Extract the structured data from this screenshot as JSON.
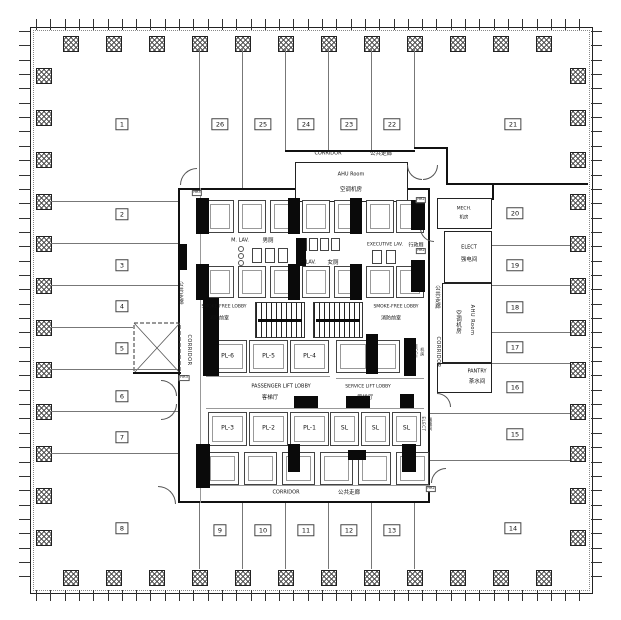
{
  "drawing": {
    "title": "office tower typical floor plan",
    "rooms": [
      "1",
      "2",
      "3",
      "4",
      "5",
      "6",
      "7",
      "8",
      "9",
      "10",
      "11",
      "12",
      "13",
      "14",
      "15",
      "16",
      "17",
      "18",
      "19",
      "20",
      "21",
      "22",
      "23",
      "24",
      "25",
      "26"
    ],
    "labels": {
      "corridor_en": "CORRIDOR",
      "corridor_zh": "公共走廊",
      "ahu_en": "AHU Room",
      "ahu_zh": "空调机房",
      "m_lav_en": "M. LAV.",
      "m_lav_zh": "男厕",
      "f_lav_en": "F. LAV.",
      "f_lav_zh": "女厕",
      "exec_lav_en": "EXECUTIVE LAV.",
      "exec_lav_zh": "行政厕",
      "smoke_free_en": "SMOKE-FREE LOBBY",
      "smoke_free_zh": "消防前室",
      "pll_en": "PASSENGER LIFT LOBBY",
      "pll_zh": "客梯厅",
      "sll_en": "SERVICE LIFT LOBBY",
      "sll_zh": "货梯厅",
      "mech_en": "MECH.",
      "mech_zh": "机房",
      "elect_en": "ELECT",
      "elect_zh": "强电间",
      "pantry_en": "PANTRY",
      "pantry_zh": "茶水间",
      "hr2": "HR2",
      "hr3": "HR3",
      "fir3": "FIR3"
    },
    "passenger_lifts": [
      "PL-6",
      "PL-5",
      "PL-4",
      "PL-3",
      "PL-2",
      "PL-1"
    ],
    "service_lifts": [
      "SL",
      "SL",
      "SL"
    ]
  }
}
